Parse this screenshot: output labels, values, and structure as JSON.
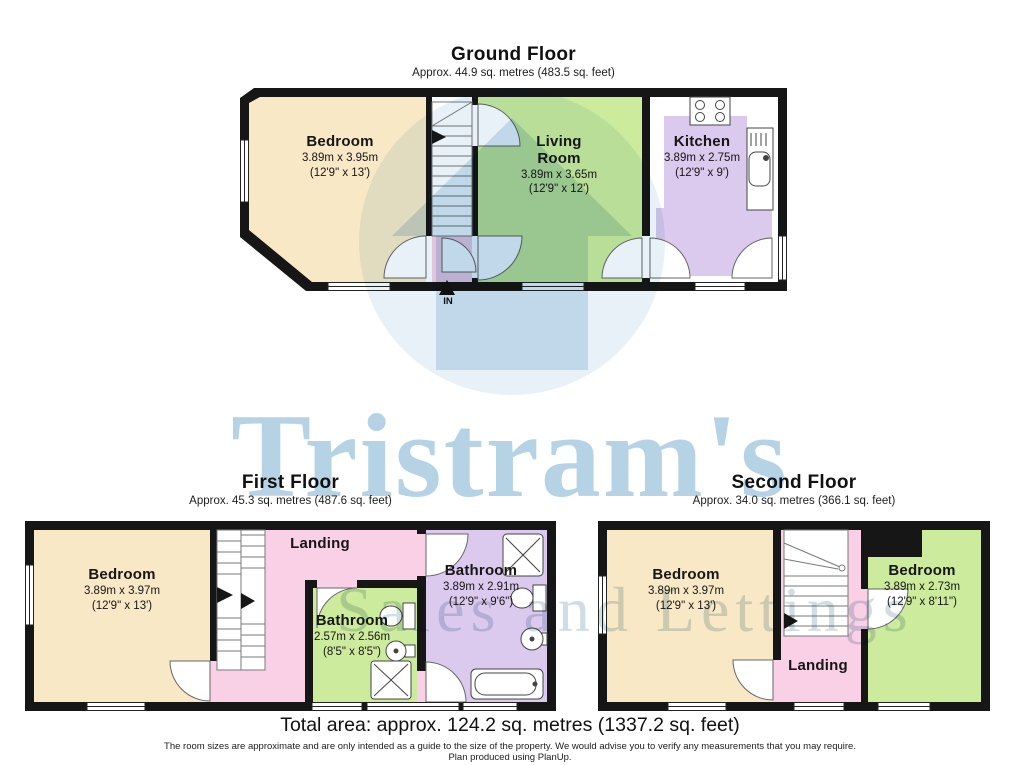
{
  "watermark": {
    "brand": "Tristram's",
    "tagline": "Sales and Lettings",
    "brand_color": "#85b6d6",
    "tagline_color": "#9fb8c7"
  },
  "colors": {
    "wall": "#161616",
    "bedroom_fill": "#f9e8c6",
    "living_fill": "#cdeb9d",
    "kitchen_bath_fill": "#dcc9ee",
    "landing_fill": "#f9d0e6",
    "window_fill": "#ffffff"
  },
  "floors": {
    "ground": {
      "title": "Ground Floor",
      "area": "Approx. 44.9 sq. metres (483.5 sq. feet)",
      "entrance": "IN",
      "rooms": {
        "bedroom": {
          "name": "Bedroom",
          "metric": "3.89m x 3.95m",
          "imperial": "(12'9\" x 13')"
        },
        "living": {
          "name": "Living Room",
          "metric": "3.89m x 3.65m",
          "imperial": "(12'9\" x 12')"
        },
        "kitchen": {
          "name": "Kitchen",
          "metric": "3.89m x 2.75m",
          "imperial": "(12'9\" x 9')"
        }
      }
    },
    "first": {
      "title": "First Floor",
      "area": "Approx. 45.3 sq. metres (487.6 sq. feet)",
      "rooms": {
        "bedroom": {
          "name": "Bedroom",
          "metric": "3.89m x 3.97m",
          "imperial": "(12'9\" x 13')"
        },
        "landing": {
          "name": "Landing"
        },
        "bathroom_small": {
          "name": "Bathroom",
          "metric": "2.57m x 2.56m",
          "imperial": "(8'5\" x 8'5\")"
        },
        "bathroom_large": {
          "name": "Bathroom",
          "metric": "3.89m x 2.91m",
          "imperial": "(12'9\" x 9'6\")"
        }
      }
    },
    "second": {
      "title": "Second Floor",
      "area": "Approx. 34.0 sq. metres (366.1 sq. feet)",
      "rooms": {
        "bedroom_left": {
          "name": "Bedroom",
          "metric": "3.89m x 3.97m",
          "imperial": "(12'9\" x 13')"
        },
        "landing": {
          "name": "Landing"
        },
        "bedroom_right": {
          "name": "Bedroom",
          "metric": "3.89m x 2.73m",
          "imperial": "(12'9\" x 8'11\")"
        }
      }
    }
  },
  "footer": {
    "total": "Total area: approx. 124.2 sq. metres (1337.2 sq. feet)",
    "disclaimer": "The room sizes are approximate and are only intended as a guide to the size of the property. We would advise you to verify any measurements that you may require.",
    "produced": "Plan produced using PlanUp."
  }
}
